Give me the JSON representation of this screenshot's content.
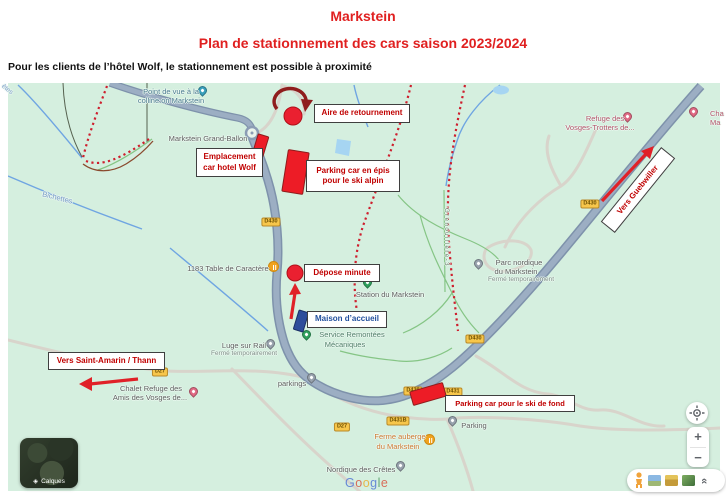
{
  "header": {
    "title": "Markstein",
    "subtitle": "Plan de stationnement des cars saison 2023/2024",
    "note": "Pour les clients de l’hôtel Wolf, le stationnement est possible à proximité"
  },
  "annotations": {
    "aire": {
      "label": "Aire de retournement"
    },
    "emplacement": {
      "line1": "Emplacement",
      "line2": "car hotel Wolf"
    },
    "epis": {
      "line1": "Parking car en épis",
      "line2": "pour le ski alpin"
    },
    "depose": {
      "label": "Dépose minute"
    },
    "maison": {
      "label": "Maison d’accueil"
    },
    "guebwiller": {
      "label": "Vers Guebwiller"
    },
    "saint_amarin": {
      "label": "Vers Saint-Amarin / Thann"
    },
    "ski_fond": {
      "label": "Parking car pour le ski de fond"
    }
  },
  "map_labels": {
    "point_de_vue": {
      "line1": "Point de vue à la",
      "line2": "colline on Markstein"
    },
    "grand_ballon": {
      "label": "Markstein Grand-Ballon"
    },
    "bichettes": {
      "label": "Bichettes"
    },
    "cretes": {
      "label": "êtes"
    },
    "table_caractere": {
      "label": "1183 Table de Caractère"
    },
    "station": {
      "label": "Station du Markstein"
    },
    "remontees": {
      "line1": "Service Remontées",
      "line2": "Mécaniques"
    },
    "parc_nordique": {
      "line1": "Parc nordique",
      "line2": "du Markstein",
      "line3": "Fermé temporairement"
    },
    "luge": {
      "line1": "Luge sur Rail",
      "line2": "Fermé temporairement"
    },
    "parkings": {
      "label": "parkings"
    },
    "chalet_refuge": {
      "line1": "Chalet Refuge des",
      "line2": "Amis des Vosges de..."
    },
    "ferme_auberge": {
      "line1": "Ferme auberge",
      "line2": "du Markstein"
    },
    "parking": {
      "label": "Parking"
    },
    "nordique_cretes": {
      "label": "Nordique des Crêtes"
    },
    "refuge_vosges": {
      "line1": "Refuge des",
      "line2": "Vosges-Trotters de..."
    },
    "chalet_edge": {
      "line1": "Cha",
      "line2": "Ma"
    },
    "grenouillere": {
      "label": "Grenouillère-3"
    }
  },
  "road_badges": {
    "d430_top": "D430",
    "d430_right": "D430",
    "d430_mid": "D430",
    "d430_bottom": "D430",
    "d431": "D431",
    "d431b": "D431B",
    "d27_west": "D27",
    "d27_south": "D27"
  },
  "controls": {
    "layers_label": "Calques",
    "zoom_in": "+",
    "zoom_out": "−"
  },
  "icons": {
    "layers_icon": "◈",
    "collapse_icon": "«"
  },
  "watermark": {
    "google": "Google",
    "letter_colors": [
      "#5c7fd6",
      "#d95f4c",
      "#e8b33c",
      "#5c7fd6",
      "#59a06b",
      "#d95f4c"
    ]
  },
  "colors": {
    "title_red": "#e02020",
    "annotation_red": "#c00000",
    "shape_red": "#ed1c26",
    "maison_blue": "#2e4d9b",
    "map_green": "#d5efdf",
    "road_gray_blue": "#9caec3"
  }
}
